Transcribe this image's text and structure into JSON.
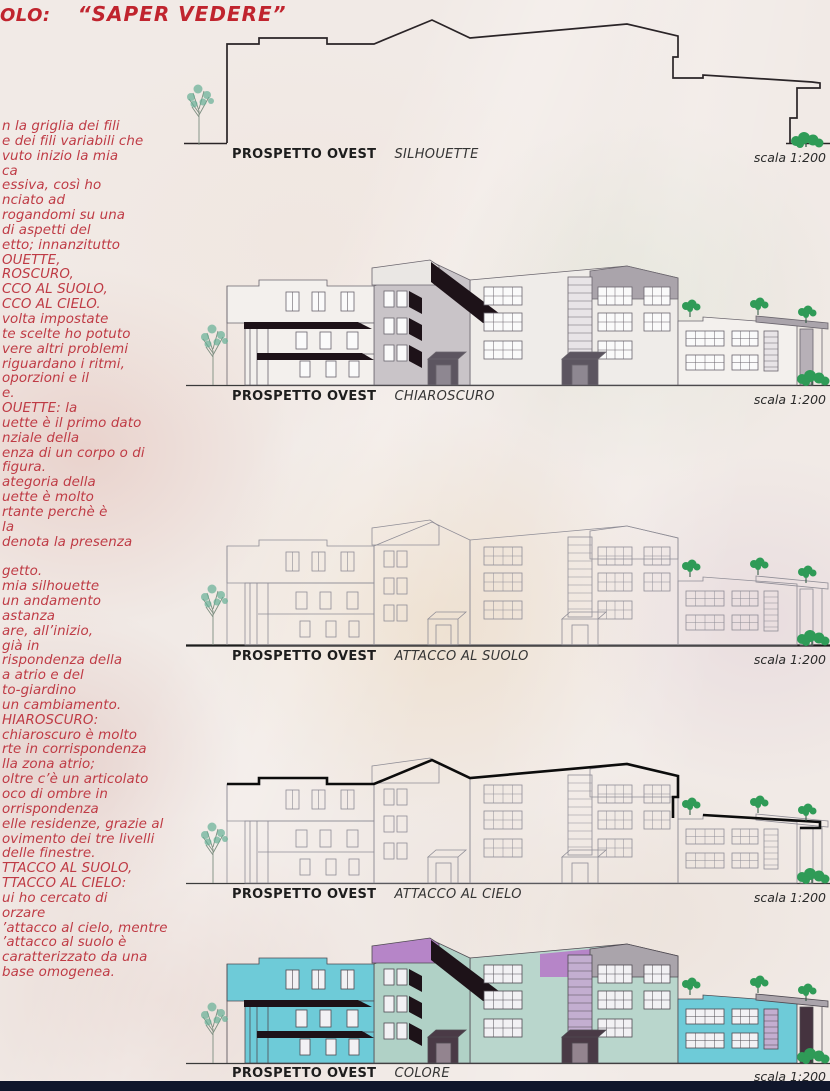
{
  "title": {
    "prefix": "OLO:",
    "main": "“SAPER VEDERE”"
  },
  "commentary": {
    "lines": [
      "n la griglia dei fili",
      "e dei fili variabili che",
      "vuto inizio la mia",
      "ca",
      "essiva, così ho",
      "nciato ad",
      "rogandomi su una",
      "di aspetti del",
      "etto; innanzitutto",
      "OUETTE,",
      "ROSCURO,",
      "CCO AL SUOLO,",
      "CCO AL CIELO.",
      "volta impostate",
      "te scelte ho potuto",
      "vere altri problemi",
      "riguardano i ritmi,",
      "oporzioni e il",
      "e.",
      "OUETTE: la",
      "uette è il primo dato",
      "nziale della",
      "enza di un corpo o di",
      "figura.",
      "ategoria della",
      "uette è molto",
      "rtante perchè è",
      "la",
      "denota la presenza",
      "",
      "getto.",
      "mia silhouette",
      "un andamento",
      "astanza",
      "are, all’inizio,",
      "già in",
      "rispondenza della",
      "a atrio e del",
      "to-giardino",
      "un cambiamento.",
      "HIAROSCURO:",
      "chiaroscuro è molto",
      "rte in corrispondenza",
      "lla zona atrio;",
      "oltre c’è un articolato",
      "oco di ombre in",
      "orrispondenza",
      "elle residenze, grazie al",
      "ovimento dei tre livelli",
      "delle finestre.",
      "TTACCO AL SUOLO,",
      "TTACCO AL CIELO:",
      "ui ho cercato di",
      "orzare",
      "’attacco al cielo, mentre",
      "’attacco al suolo è",
      "caratterizzato da una",
      "base omogenea."
    ]
  },
  "sections": [
    {
      "name": "PROSPETTO OVEST",
      "variant": "SILHOUETTE",
      "scale": "scala 1:200"
    },
    {
      "name": "PROSPETTO OVEST",
      "variant": "CHIAROSCURO",
      "scale": "scala 1:200"
    },
    {
      "name": "PROSPETTO OVEST",
      "variant": "ATTACCO AL SUOLO",
      "scale": "scala 1:200"
    },
    {
      "name": "PROSPETTO OVEST",
      "variant": "ATTACCO AL CIELO",
      "scale": "scala 1:200"
    },
    {
      "name": "PROSPETTO OVEST",
      "variant": "COLORE",
      "scale": "scala 1:200"
    }
  ],
  "colors": {
    "title_red": "#c0242e",
    "red_text": "#bf3b45",
    "cyan": "#6ecbd8",
    "purple": "#b685c8",
    "sage": "#b0d1c6",
    "lavender": "#c3aed0",
    "gray_volume": "#aaa4ab",
    "shadow": "#1d1218",
    "tree_green": "#2f9b57",
    "tree_teal": "#66b096",
    "line_gray": "#8f8d96",
    "bottom_strip": "#10162b",
    "paper": "#f1eae6"
  }
}
